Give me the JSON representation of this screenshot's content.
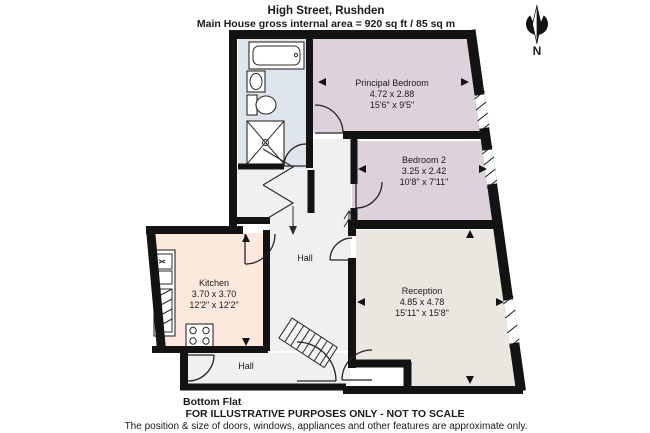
{
  "header": {
    "title": "High Street, Rushden",
    "subtitle": "Main House gross internal area = 920 sq ft / 85 sq m"
  },
  "compass": {
    "label": "N"
  },
  "rooms": {
    "principal_bedroom": {
      "name": "Principal Bedroom",
      "metric": "4.72 x 2.88",
      "imperial": "15'6\" x 9'5\""
    },
    "bedroom2": {
      "name": "Bedroom 2",
      "metric": "3.25 x 2.42",
      "imperial": "10'8\" x 7'11\""
    },
    "kitchen": {
      "name": "Kitchen",
      "metric": "3.70 x 3.70",
      "imperial": "12'2\" x 12'2\""
    },
    "reception": {
      "name": "Reception",
      "metric": "4.85 x 4.78",
      "imperial": "15'11\" x 15'8\""
    },
    "hall": {
      "name": "Hall"
    },
    "hall_bottom": {
      "name": "Hall"
    }
  },
  "floor_label": "Bottom Flat",
  "footer": {
    "line1": "FOR ILLUSTRATIVE PURPOSES ONLY - NOT TO SCALE",
    "line2": "The position & size of doors, windows, appliances and other features are approximate only."
  },
  "colors": {
    "wall": "#131313",
    "bedroom_fill": "#ddd1db",
    "bathroom_fill": "#dfe5ec",
    "kitchen_fill": "#fce8dd",
    "reception_fill": "#ebe6df",
    "hall_fill": "#eef0f1"
  }
}
